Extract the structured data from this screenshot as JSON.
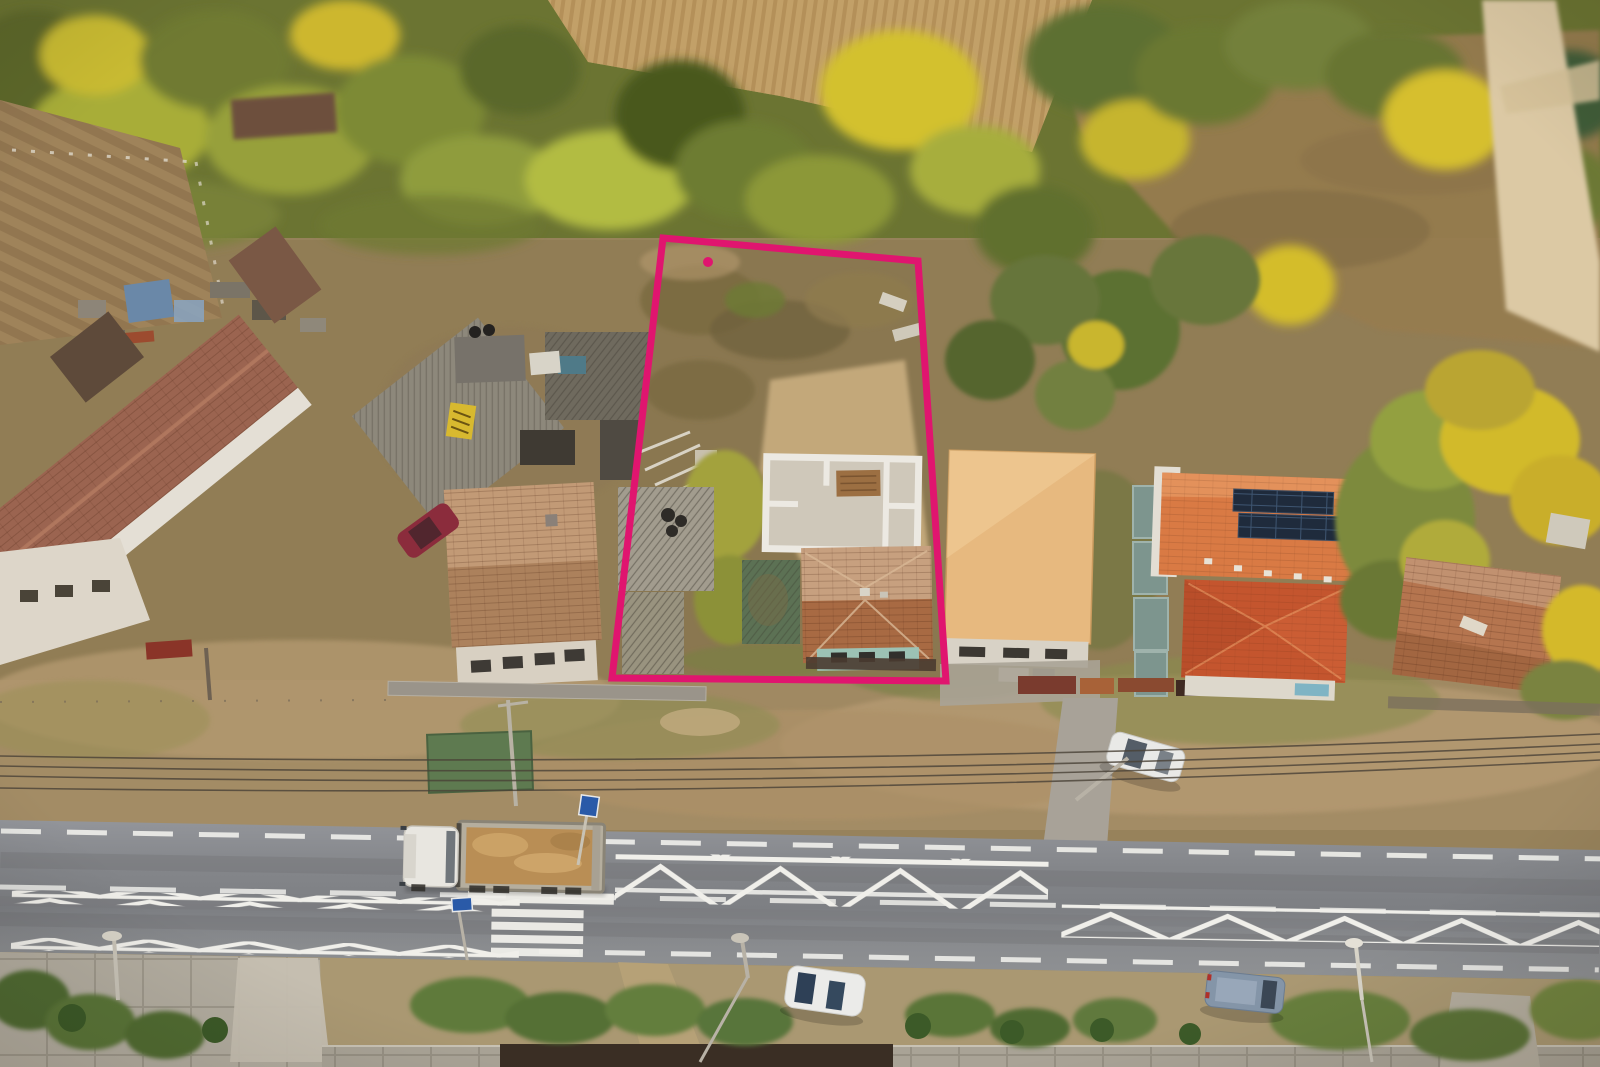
{
  "image": {
    "kind": "aerial-drone-photo",
    "subject": "Top-down aerial photo of a rural street; a vacant construction plot is outlined with a magenta boundary marker between neighbouring houses, with a main road, dump truck, parked cars, autumn trees and fields"
  },
  "boundary_overlay": {
    "color": "#E0156F",
    "points": "663,238 918,261 946,681 612,678",
    "stroke_width": 7,
    "dot_cx": 708,
    "dot_cy": 262,
    "dot_r": 5
  },
  "palette": {
    "ground_tan": "#97825b",
    "forest_green": "#6b7432",
    "leaf_yellow": "#d3c12e",
    "cornfield": "#c2a068",
    "dirt_path": "#dcc9a4",
    "long_house_roof": "#9b6450",
    "weathered_tile": "#c29a76",
    "rust_tile": "#a86a43",
    "orange_roof": "#d97a44",
    "red_roof": "#c4552e",
    "tan_big_roof": "#e7b97f",
    "gray_roof": "#a29c8e",
    "green_shed": "#5c7154",
    "teal_wall": "#9cc2b4",
    "white_wall": "#e9e5dc",
    "solar_panel": "#1f2b3c",
    "road_asphalt": "#84868a",
    "road_marking": "#f0efea",
    "sand_load": "#b98e55",
    "maroon_car": "#8b2c3c",
    "van_blue": "#8495a8",
    "boundary_pink": "#E0156F"
  },
  "objects": [
    {
      "name": "plot-boundary-overlay",
      "note": "magenta rectangle outlining vacant plot"
    },
    {
      "name": "vacant-plot",
      "note": "cleared scrub land with debris and dirt patches"
    },
    {
      "name": "unfinished-building",
      "note": "roofless white block walls inside plot"
    },
    {
      "name": "old-house-teal",
      "note": "hipped weathered tile roof, teal walls, inside plot"
    },
    {
      "name": "gray-corrugated-barn",
      "note": "long gray roof on left edge of plot"
    },
    {
      "name": "orange-house-solar",
      "note": "orange roof with two rows of solar panels"
    },
    {
      "name": "tan-warehouse",
      "note": "large light-orange flat roof building right of plot"
    },
    {
      "name": "long-farmhouse",
      "note": "long diagonal brown tile roof, far left"
    },
    {
      "name": "weathered-house",
      "note": "square tiled roof house left of plot"
    },
    {
      "name": "rusty-roof-house",
      "note": "old house far right among yellow trees"
    },
    {
      "name": "dump-truck",
      "note": "white cab truck loaded with sand on road"
    },
    {
      "name": "maroon-car",
      "note": "parked dark red car"
    },
    {
      "name": "white-sedan",
      "note": "parked by gate driveway"
    },
    {
      "name": "white-car-shoulder",
      "note": "parked below road"
    },
    {
      "name": "blue-van",
      "note": "parked bottom right"
    },
    {
      "name": "zebra-crossing",
      "note": "pedestrian crossing with zigzag approach markings"
    },
    {
      "name": "cornfield",
      "note": "dry maize field top centre"
    },
    {
      "name": "dirt-road",
      "note": "pale gravel lane top right"
    },
    {
      "name": "power-lines",
      "note": "wires crossing above road shoulder"
    }
  ]
}
